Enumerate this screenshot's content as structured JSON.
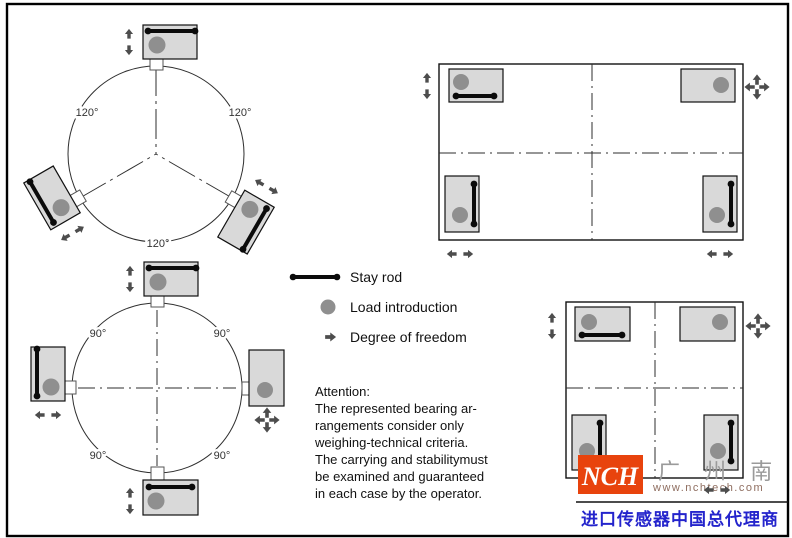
{
  "diagram": {
    "tripod": {
      "angle_label": "120°"
    },
    "quad_circle": {
      "angle_label": "90°"
    }
  },
  "legend": {
    "stay_rod": "Stay rod",
    "load_introduction": "Load introduction",
    "degree_of_freedom": "Degree of freedom"
  },
  "attention": {
    "title": "Attention:",
    "line1": "The represented bearing ar-",
    "line2": "rangements consider only",
    "line3": "weighing-technical criteria.",
    "line4": "The carrying and stabilitymust",
    "line5": "be examined and guaranteed",
    "line6": "in each case by the operator."
  },
  "logo": {
    "abbr": "NCH",
    "company": "广 州 南 创",
    "website": "www.nchtech.com",
    "tagline": "进口传感器中国总代理商"
  },
  "colors": {
    "accent_red": "#e8430d",
    "tagline_blue": "#2424cc",
    "pad_gray": "#d9d9d9",
    "load_gray": "#8f8f8f",
    "arrow_gray": "#4d4d4d"
  }
}
